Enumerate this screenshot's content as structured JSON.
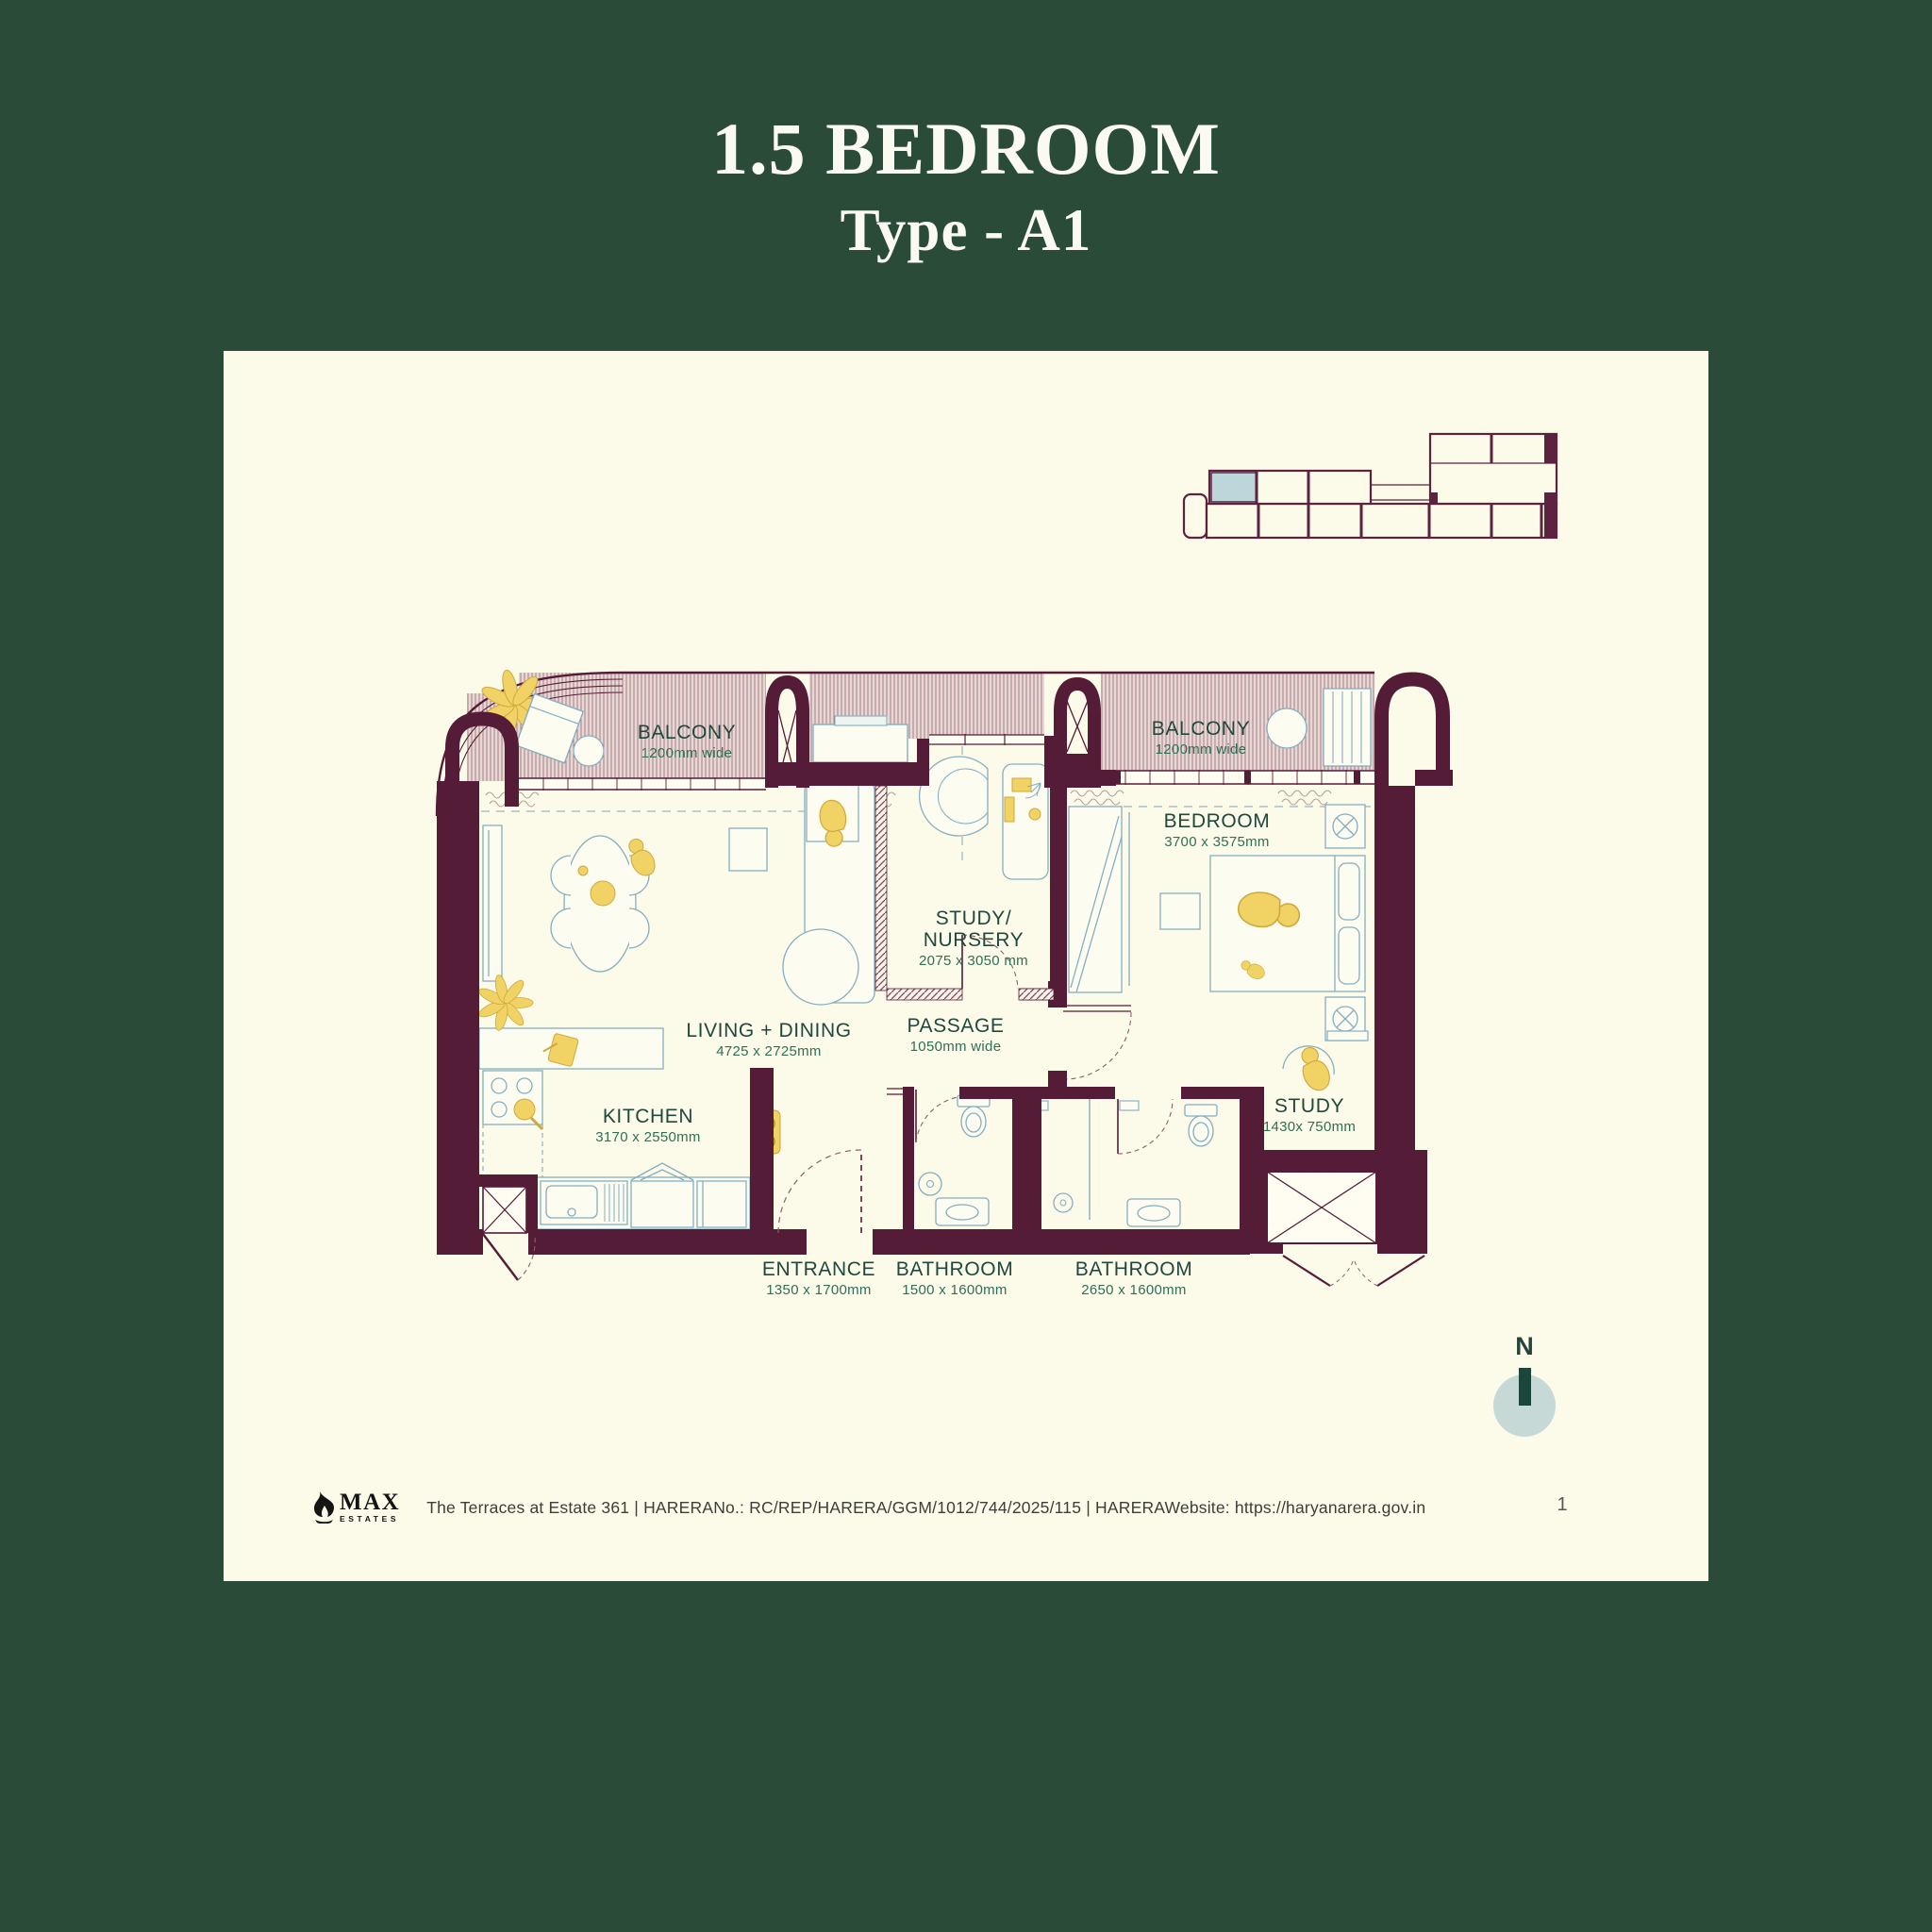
{
  "title": {
    "line1": "1.5 BEDROOM",
    "line2": "Type - A1"
  },
  "plan": {
    "rooms": {
      "balcony_left": {
        "name": "BALCONY",
        "dims": "1200mm wide"
      },
      "balcony_right": {
        "name": "BALCONY",
        "dims": "1200mm wide"
      },
      "bedroom": {
        "name": "BEDROOM",
        "dims": "3700 x 3575mm"
      },
      "study_nursery": {
        "line1": "STUDY/",
        "line2": "NURSERY",
        "dims": "2075 x 3050 mm"
      },
      "living_dining": {
        "name": "LIVING + DINING",
        "dims": "4725 x 2725mm"
      },
      "passage": {
        "name": "PASSAGE",
        "dims": "1050mm wide"
      },
      "kitchen": {
        "name": "KITCHEN",
        "dims": "3170 x 2550mm"
      },
      "study": {
        "name": "STUDY",
        "dims": "1430x 750mm"
      },
      "entrance": {
        "name": "ENTRANCE",
        "dims": "1350 x 1700mm"
      },
      "bathroom_1": {
        "name": "BATHROOM",
        "dims": "1500 x 1600mm"
      },
      "bathroom_2": {
        "name": "BATHROOM",
        "dims": "2650 x 1600mm"
      }
    }
  },
  "compass": {
    "label": "N"
  },
  "footer": {
    "brand": {
      "name": "MAX",
      "sub": "ESTATES"
    },
    "text": "The Terraces at Estate 361  |  HARERANo.: RC/REP/HARERA/GGM/1012/744/2025/115 |  HARERAWebsite: https://haryanarera.gov.in"
  },
  "page_number": "1",
  "colors": {
    "background_green": "#2a4b38",
    "card_cream": "#fcfae9",
    "wall_maroon": "#551c38",
    "label_teal": "#20483f",
    "dims_green": "#2f6f58",
    "furniture_blue": "#85aec0",
    "accent_yellow": "#f1d264",
    "compass_fill": "#c7d9d6",
    "keyplan_highlight": "#bcd6da"
  }
}
